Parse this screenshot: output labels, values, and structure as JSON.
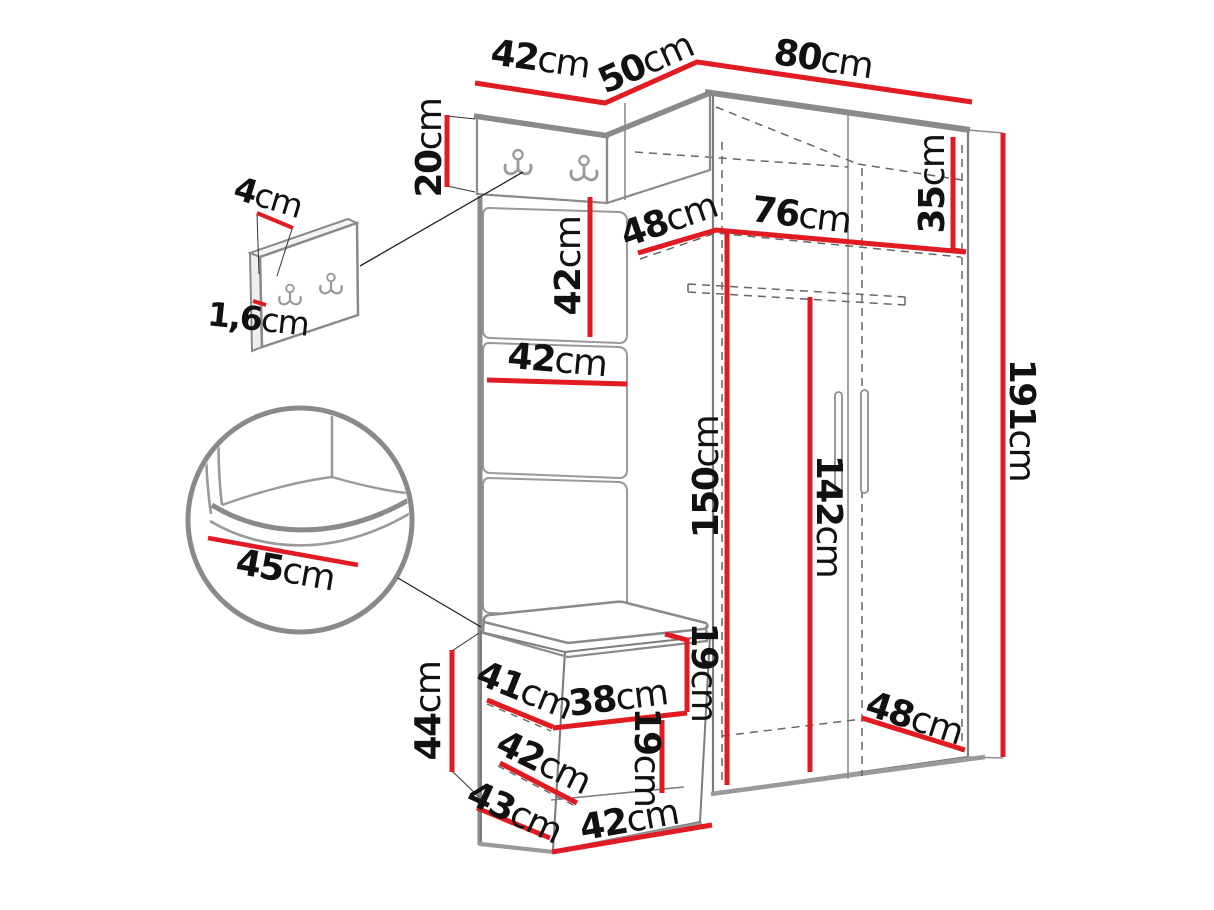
{
  "figure_type": "furniture-dimension-diagram",
  "colors": {
    "dimension_line": "#e11b22",
    "outline": "#8a8a8a",
    "dashed": "#666666",
    "text": "#111111"
  },
  "unit": "cm",
  "dims": {
    "top_width_42": {
      "num": "42",
      "unit": "cm"
    },
    "top_width_50": {
      "num": "50",
      "unit": "cm"
    },
    "top_width_80": {
      "num": "80",
      "unit": "cm"
    },
    "hook_board_height_20": {
      "num": "20",
      "unit": "cm"
    },
    "hook_panel_depth_4": {
      "num": "4",
      "unit": "cm"
    },
    "hook_panel_thickness_16": {
      "num": "1,6",
      "unit": "cm"
    },
    "upholstered_panel_42": {
      "num": "42",
      "unit": "cm"
    },
    "top_shelf_depth_48": {
      "num": "48",
      "unit": "cm"
    },
    "interior_width_76": {
      "num": "76",
      "unit": "cm"
    },
    "top_shelf_height_35": {
      "num": "35",
      "unit": "cm"
    },
    "panel_width_42": {
      "num": "42",
      "unit": "cm"
    },
    "hanging_space_150": {
      "num": "150",
      "unit": "cm"
    },
    "rail_height_142": {
      "num": "142",
      "unit": "cm"
    },
    "total_height_191": {
      "num": "191",
      "unit": "cm"
    },
    "seat_width_45": {
      "num": "45",
      "unit": "cm"
    },
    "bench_height_44": {
      "num": "44",
      "unit": "cm"
    },
    "bench_depth_41": {
      "num": "41",
      "unit": "cm"
    },
    "bench_shelf_width_38": {
      "num": "38",
      "unit": "cm"
    },
    "bench_opening_upper_19": {
      "num": "19",
      "unit": "cm"
    },
    "bench_opening_lower_19": {
      "num": "19",
      "unit": "cm"
    },
    "bench_depth_42": {
      "num": "42",
      "unit": "cm"
    },
    "bench_base_depth_43": {
      "num": "43",
      "unit": "cm"
    },
    "bench_width_42": {
      "num": "42",
      "unit": "cm"
    },
    "wardrobe_depth_48": {
      "num": "48",
      "unit": "cm"
    }
  }
}
